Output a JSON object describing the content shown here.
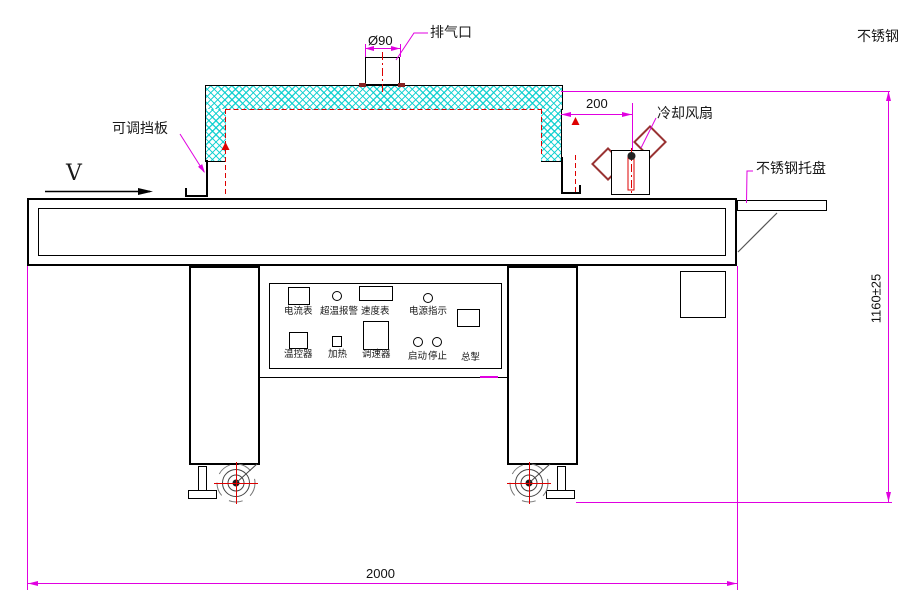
{
  "colors": {
    "dimension_line": "#e000e0",
    "centerline_red": "#dd0000",
    "hatch_cyan": "#00cdcd",
    "outline_black": "#000000",
    "fan_blade_dark_red": "#993333"
  },
  "callouts": {
    "exhaust": "排气口",
    "diameter": "Ø90",
    "stainless_clipped": "不锈钢",
    "baffle": "可调挡板",
    "fan": "冷却风扇",
    "tray": "不锈钢托盘",
    "direction": "V"
  },
  "dims": {
    "offset": "200",
    "height": "1160±25",
    "length": "2000"
  },
  "panel": {
    "ammeter": "电流表",
    "overtemp": "超温报警",
    "speedometer": "速度表",
    "power": "电源指示",
    "thermostat": "温控器",
    "heating": "加热",
    "regulator": "调速器",
    "start": "启动",
    "stop": "停止",
    "master": "总掣"
  }
}
